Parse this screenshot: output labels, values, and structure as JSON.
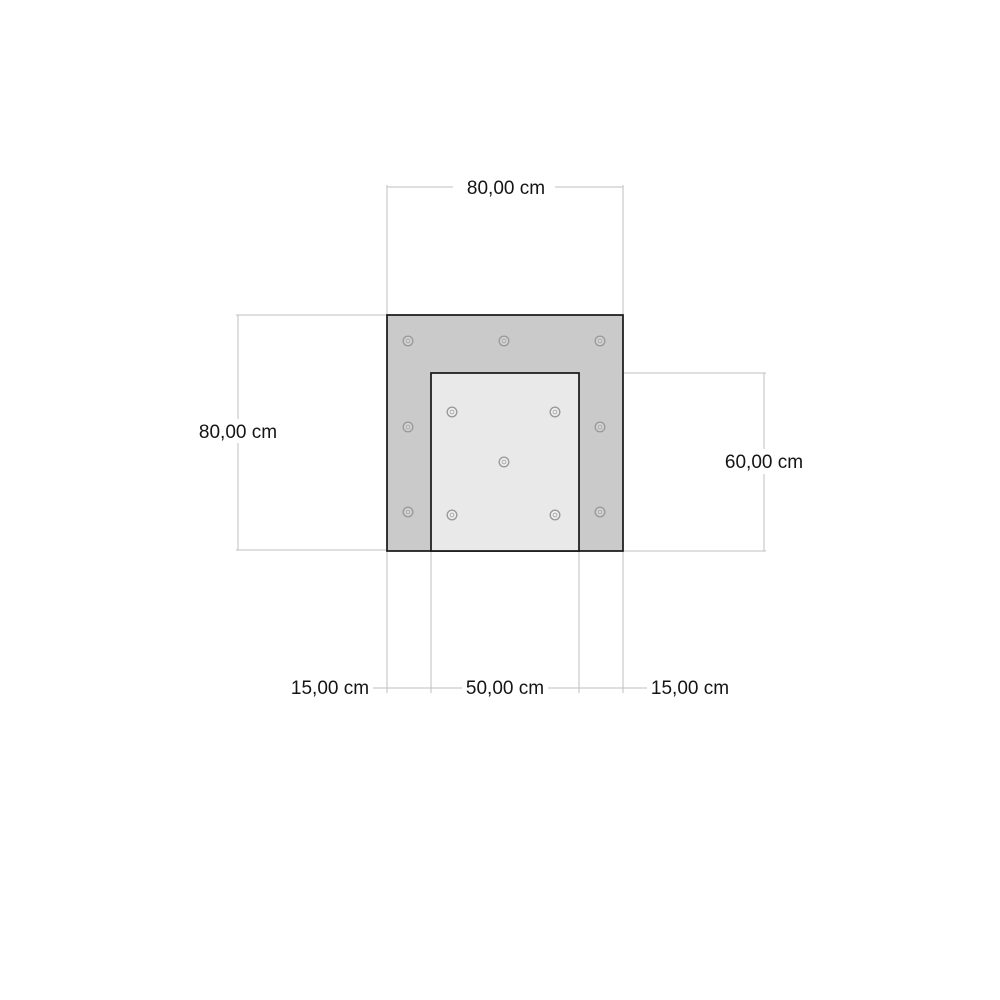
{
  "drawing": {
    "type": "technical-dimension-drawing",
    "unit": "cm",
    "labels": {
      "top_width": "80,00 cm",
      "left_height": "80,00 cm",
      "right_inner_height": "60,00 cm",
      "bottom_left_margin": "15,00 cm",
      "bottom_inner_width": "50,00 cm",
      "bottom_right_margin": "15,00 cm"
    },
    "values": {
      "outer_width_cm": 80.0,
      "outer_height_cm": 80.0,
      "inner_width_cm": 50.0,
      "inner_height_cm": 60.0,
      "side_margin_cm": 15.0
    },
    "colors": {
      "background": "#ffffff",
      "frame_fill": "#cacaca",
      "inner_fill": "#e9e9e9",
      "outline": "#161616",
      "dimension_line": "#bfbfbf",
      "label_text": "#141414",
      "hole_stroke": "#9a9a9a",
      "hole_fill_on_frame": "#d4d4d4",
      "hole_fill_on_inner": "#f0f0f0"
    },
    "holes": {
      "frame": [
        [
          408,
          341
        ],
        [
          504,
          341
        ],
        [
          600,
          341
        ],
        [
          408,
          427
        ],
        [
          600,
          427
        ],
        [
          408,
          512
        ],
        [
          600,
          512
        ]
      ],
      "inner": [
        [
          452,
          412
        ],
        [
          555,
          412
        ],
        [
          452,
          515
        ],
        [
          555,
          515
        ],
        [
          504,
          462
        ]
      ]
    },
    "hole_counts": {
      "frame": 7,
      "inner": 5,
      "total": 12
    }
  }
}
